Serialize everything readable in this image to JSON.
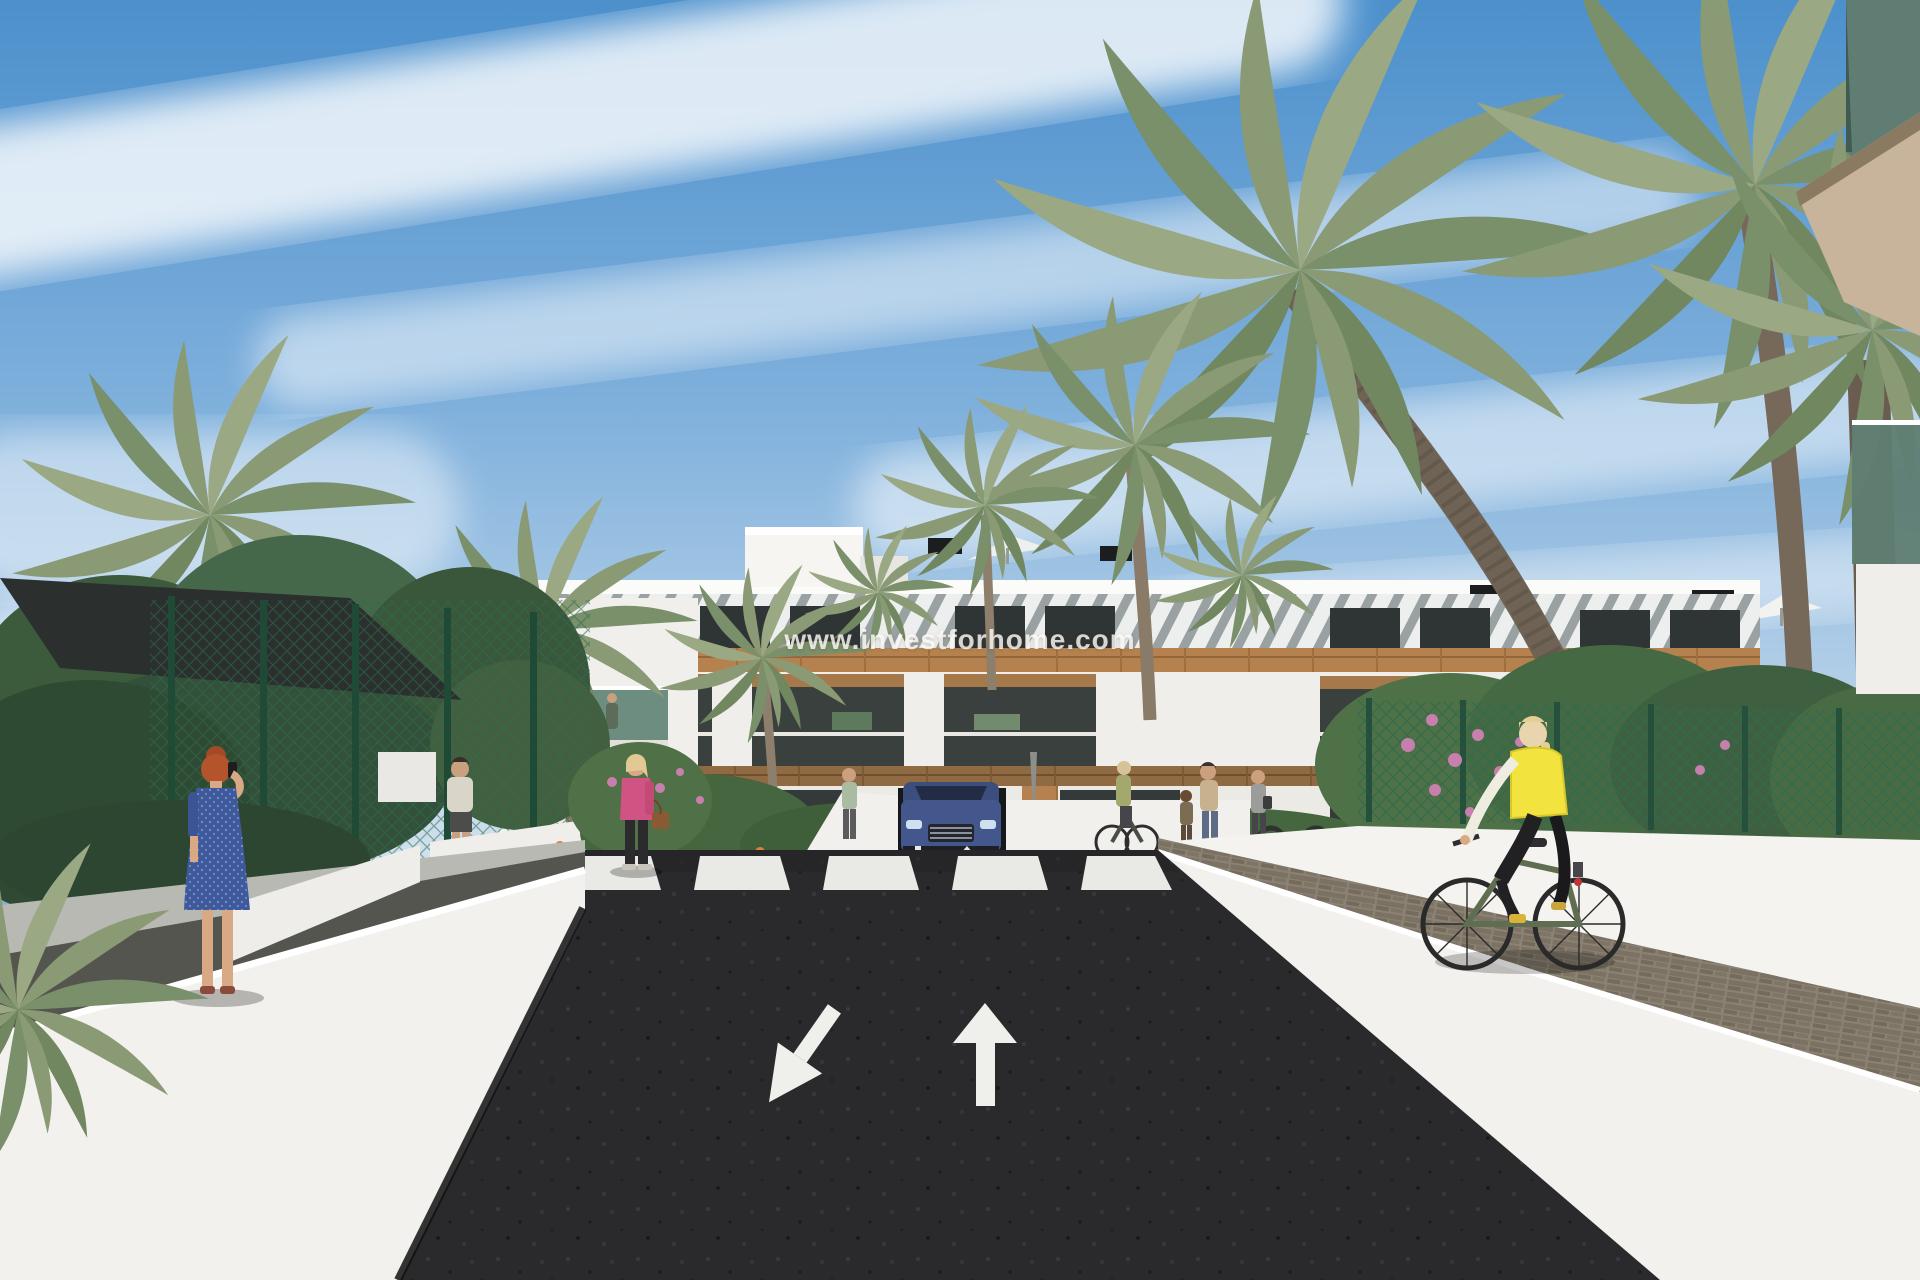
{
  "watermark": {
    "text": "www.investforhome.com"
  },
  "scene": {
    "type": "3d-architectural-rendering",
    "subject": "modern white apartment complex with palm trees, access road, crosswalk and garage ramp",
    "road_markings": {
      "left_lane_arrow": "down-left",
      "right_lane_arrow": "up",
      "crosswalk_stripe_count": 5,
      "ramp_arrows": "down-left and up"
    },
    "vehicle": "blue SUV exiting underground garage ramp",
    "figures": [
      "red-haired woman in blue dress on phone",
      "man in white t-shirt walking away",
      "blonde woman in pink jacket with handbag",
      "blonde woman cycling with yellow vest on green bike",
      "mother with child near building",
      "woman walking away with dark bag",
      "cyclist near bike racks",
      "pedestrian at crosswalk",
      "couple on balcony"
    ]
  },
  "colors": {
    "sky_top": "#4c90cc",
    "sky_horizon": "#cfe0ee",
    "cloud": "#ffffff",
    "building_white": "#f2f1ed",
    "wood_accent": "#b5824f",
    "window_glass": "#33393a",
    "palm_green": "#8a9a74",
    "fence_green": "#2f6b4d",
    "asphalt": "#2a2a2c",
    "wall_white": "#f4f3ef",
    "cobble_path": "#8b8274",
    "vest_yellow": "#f2e33e",
    "jacket_pink": "#cf5383",
    "dress_blue": "#3f5a9c",
    "car_blue": "#44578d",
    "flower_orange": "#d7813b",
    "flower_pink": "#c77fae"
  }
}
